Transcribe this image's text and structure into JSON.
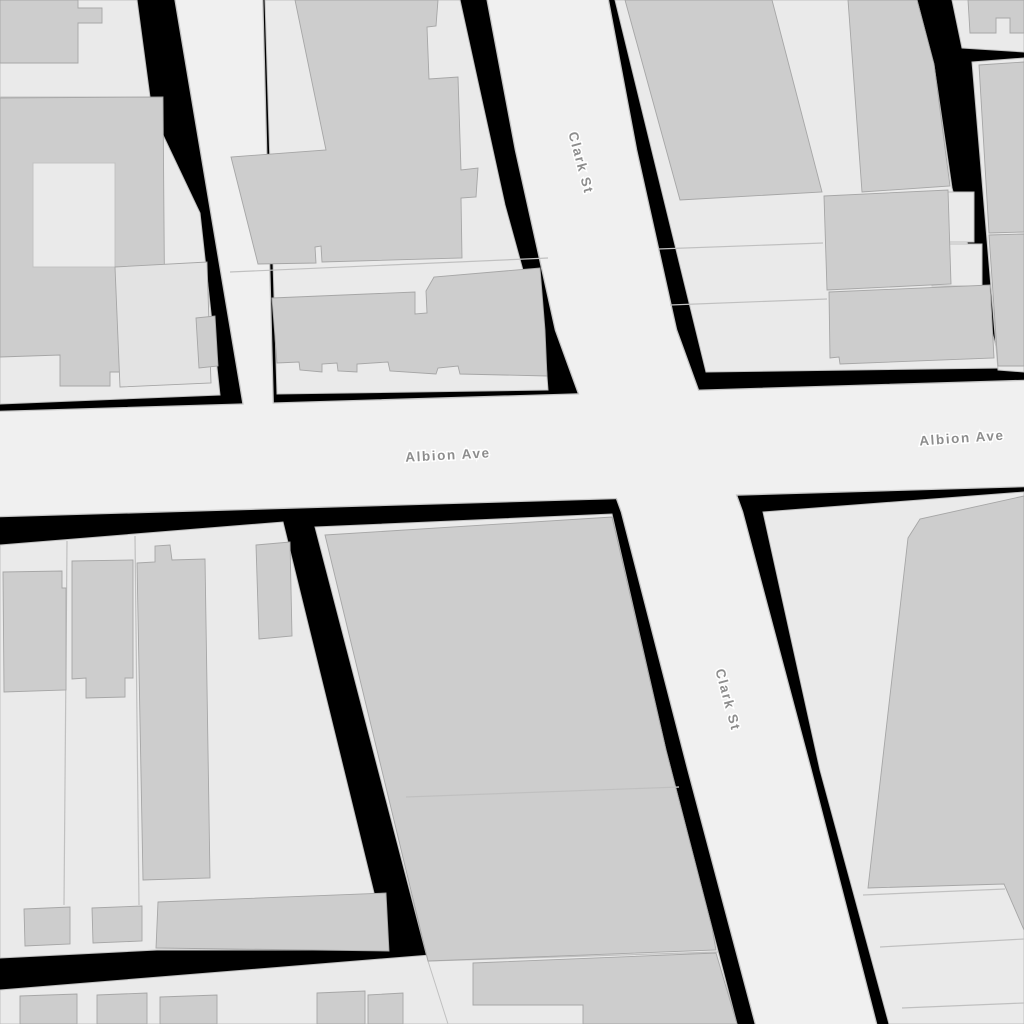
{
  "map": {
    "street_labels": [
      {
        "id": "clark-st-upper-label",
        "text": "Clark St",
        "x": 580,
        "y": 163,
        "rotation": 75
      },
      {
        "id": "clark-st-lower-label",
        "text": "Clark St",
        "x": 727,
        "y": 700,
        "rotation": 75
      },
      {
        "id": "albion-ave-left-label",
        "text": "Albion Ave",
        "x": 448,
        "y": 456,
        "rotation": -3
      },
      {
        "id": "albion-ave-right-label",
        "text": "Albion Ave",
        "x": 962,
        "y": 439,
        "rotation": -4
      }
    ],
    "colors": {
      "background": "#000000",
      "road": "#f0f0f0",
      "road_casing": "#c6c6c6",
      "block_lot": "#eaeaea",
      "lot_line": "#c0c0c0",
      "building": "#cdcdcd",
      "building_outline": "#a6a6a6",
      "building_light": "#e3e3e3",
      "label_text": "#8d8d8d",
      "label_halo": "#ffffff"
    }
  }
}
